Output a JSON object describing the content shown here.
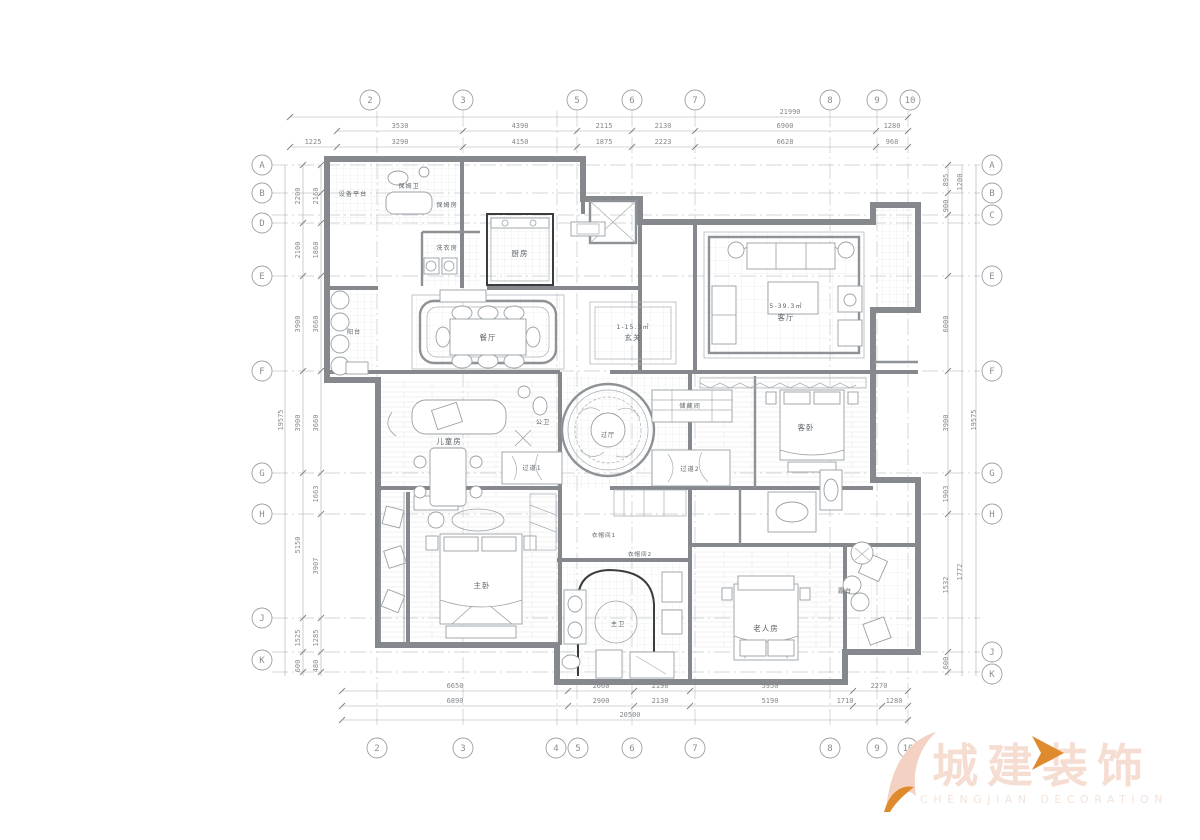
{
  "grid": {
    "top": [
      "2",
      "3",
      "5",
      "6",
      "7",
      "8",
      "9",
      "10"
    ],
    "bottom": [
      "2",
      "3",
      "4",
      "5",
      "6",
      "7",
      "8",
      "9",
      "10"
    ],
    "left": [
      "A",
      "B",
      "D",
      "E",
      "F",
      "G",
      "H",
      "J",
      "K"
    ],
    "right": [
      "A",
      "B",
      "C",
      "E",
      "F",
      "G",
      "H",
      "J",
      "K"
    ]
  },
  "dims": {
    "top_total": "21990",
    "top_row1": [
      "3530",
      "4390",
      "2115",
      "2130",
      "6900",
      "1280"
    ],
    "top_row2": [
      "1225",
      "3290",
      "4150",
      "1875",
      "2223",
      "6628",
      "968"
    ],
    "bottom_row1": [
      "6650",
      "2660",
      "2190",
      "5950",
      "2270"
    ],
    "bottom_row2": [
      "6890",
      "2900",
      "2130",
      "5190",
      "1710",
      "1280"
    ],
    "bottom_total": "20500",
    "left_total": "19575",
    "left_col1": [
      "2200",
      "2100",
      "3900",
      "3900",
      "5150",
      "1525",
      "600"
    ],
    "left_col2": [
      "2160",
      "1860",
      "3660",
      "3660",
      "1663",
      "3907",
      "1285",
      "480"
    ],
    "right_total": "19575",
    "right_col1": [
      "895",
      "900",
      "6000",
      "3900",
      "1903",
      "1532",
      "600"
    ],
    "right_col2": [
      "1200",
      "1772"
    ]
  },
  "rooms": {
    "equipment_platform": "设备平台",
    "nanny_bath": "保姆卫",
    "nanny_room": "保姆房",
    "laundry": "洗衣房",
    "kitchen": "厨房",
    "dining": "餐厅",
    "foyer": "玄关",
    "foyer_area": "1-15.3㎡",
    "living": "客厅",
    "living_area": "5-39.3㎡",
    "balcony": "阳台",
    "kids": "儿童房",
    "guest_bath": "公卫",
    "hall": "过厅",
    "storage": "储藏间",
    "corridor1": "过道1",
    "corridor2": "过道2",
    "guest_bed": "客卧",
    "closet1": "衣帽间1",
    "closet2": "衣帽间2",
    "master": "主卧",
    "master_bath": "主卫",
    "elder": "老人房",
    "terrace": "露台"
  },
  "logo": {
    "cn": "城建装饰",
    "en": "CHENGJIAN DECORATION",
    "accent_color": "#e08a2e",
    "watermark_color": "#f6ddd2"
  }
}
